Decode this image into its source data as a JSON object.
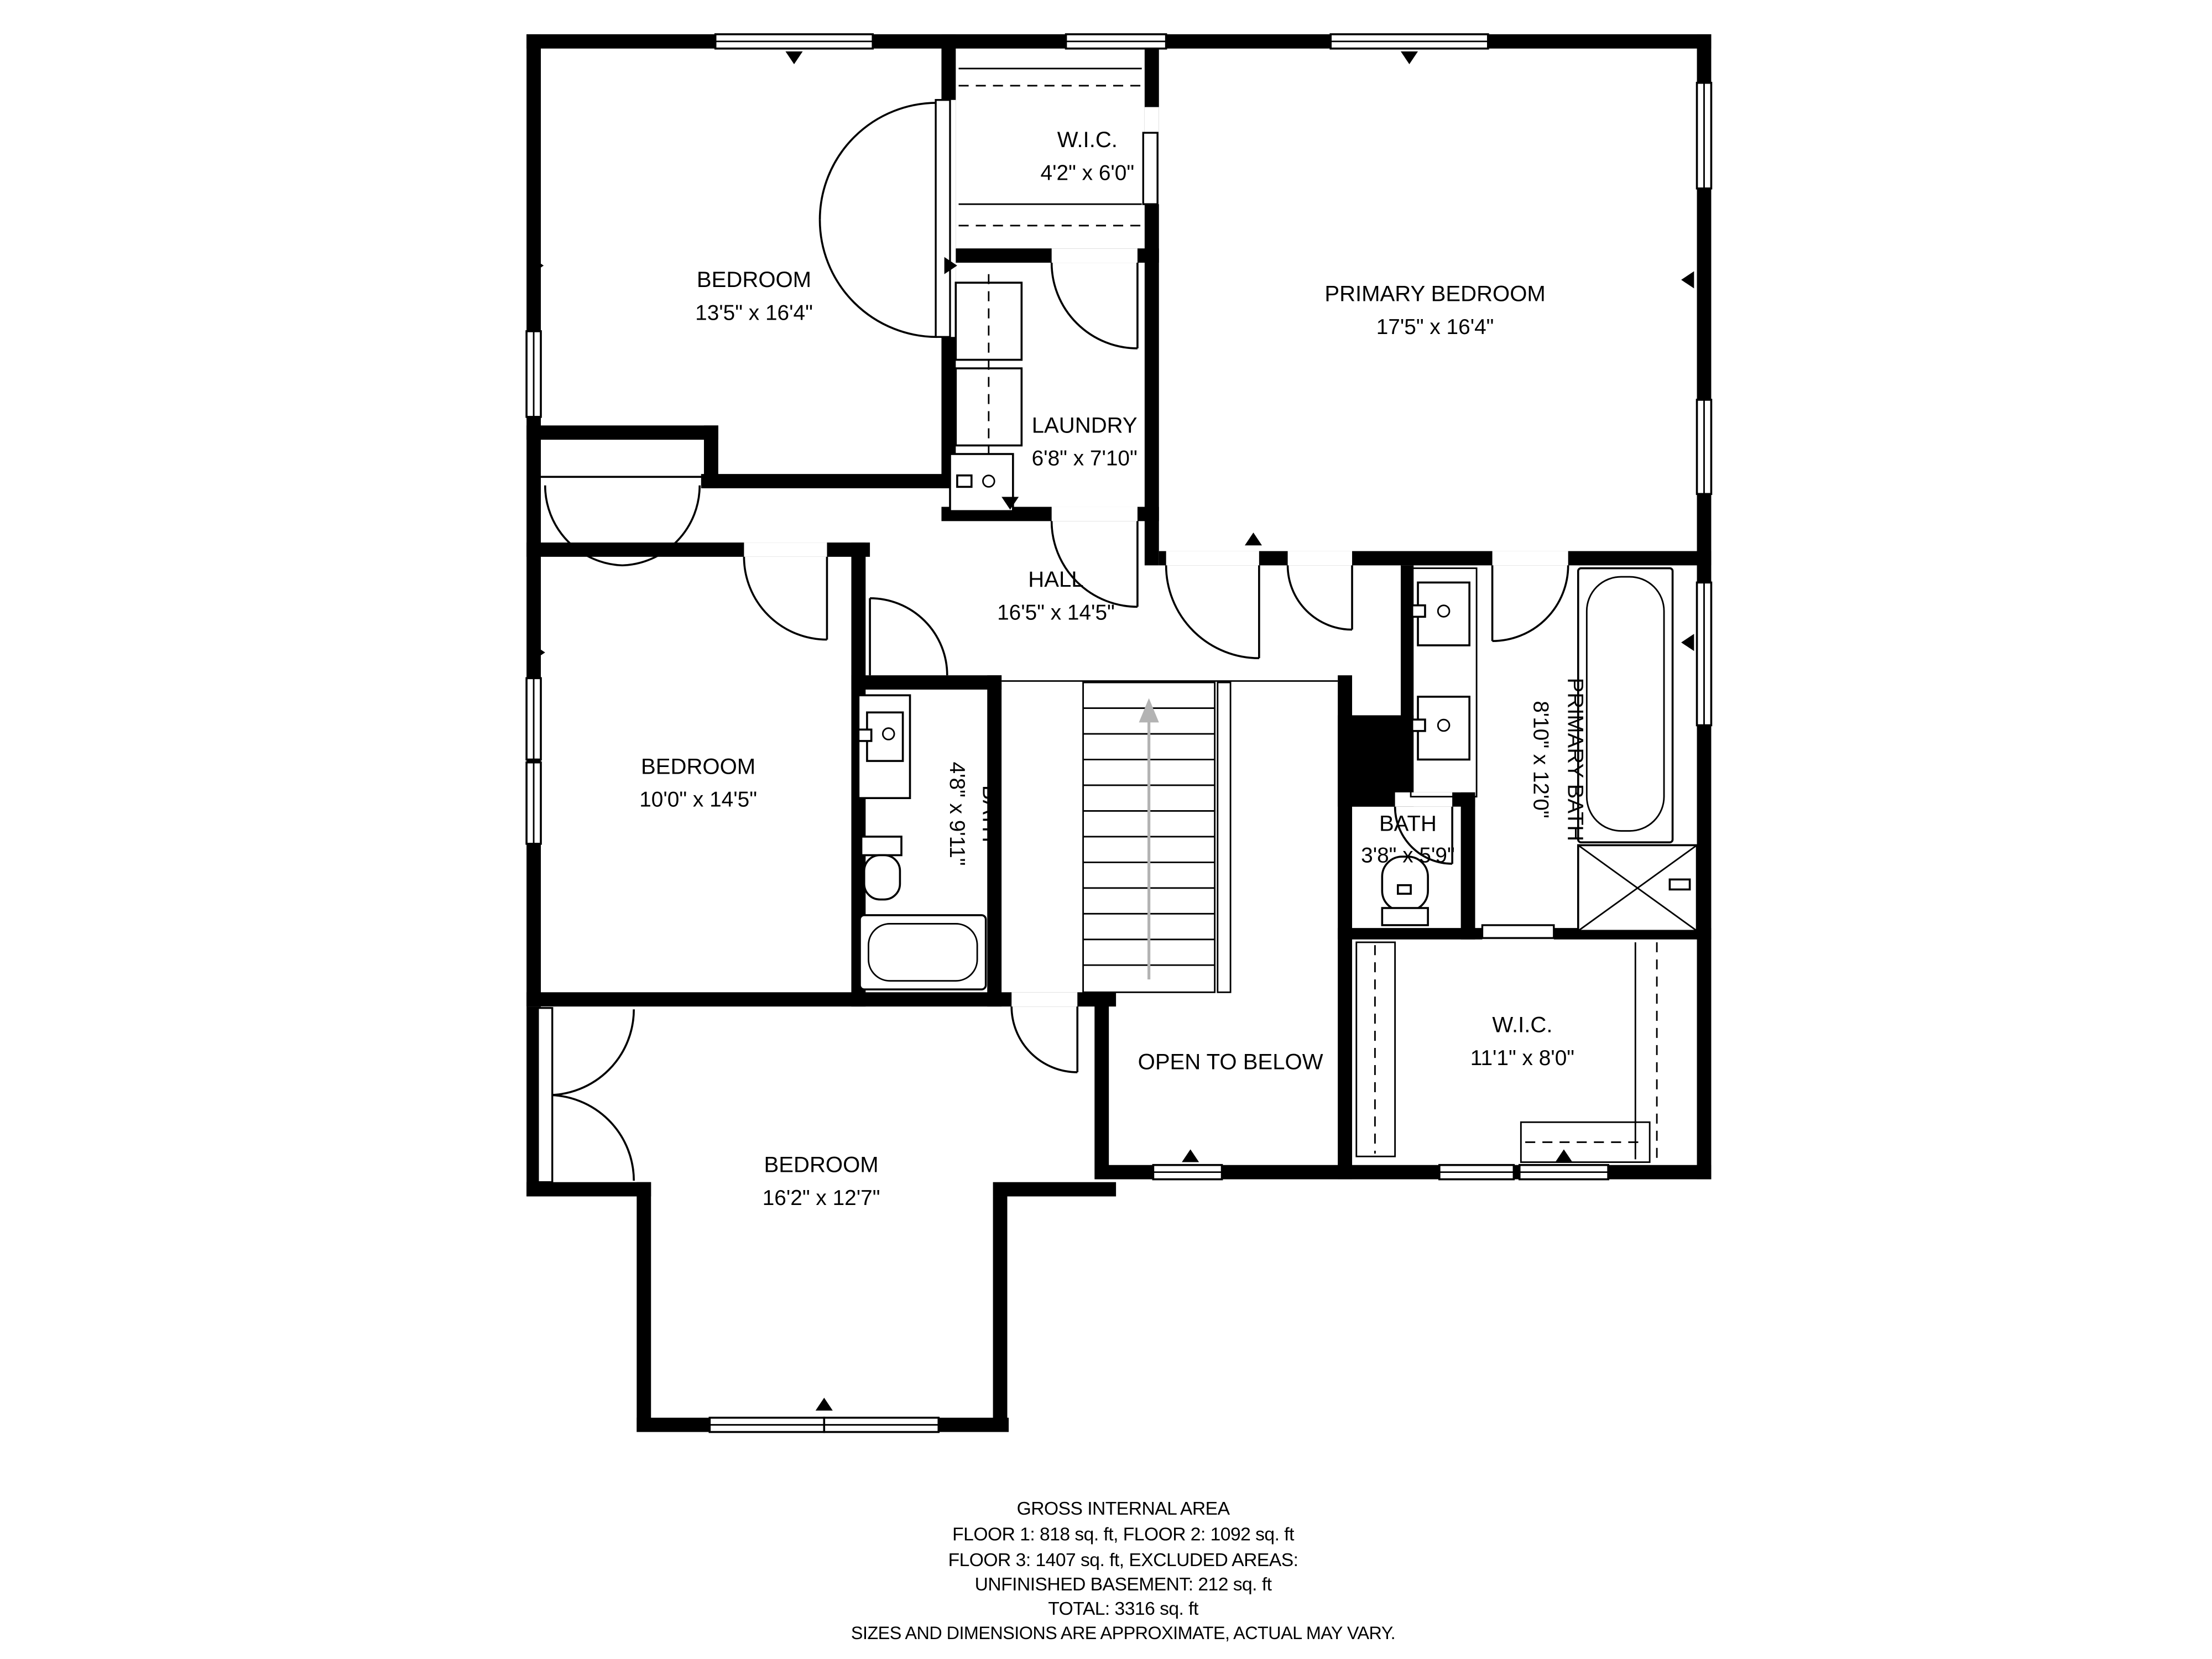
{
  "plan": {
    "title": "Floor plan - Floor 2",
    "rooms": [
      {
        "id": "bedroom-top-left",
        "name": "BEDROOM",
        "dims": "13'5\" x 16'4\""
      },
      {
        "id": "wic-top",
        "name": "W.I.C.",
        "dims": "4'2\" x 6'0\""
      },
      {
        "id": "primary-bedroom",
        "name": "PRIMARY BEDROOM",
        "dims": "17'5\" x 16'4\""
      },
      {
        "id": "laundry",
        "name": "LAUNDRY",
        "dims": "6'8\" x 7'10\""
      },
      {
        "id": "hall",
        "name": "HALL",
        "dims": "16'5\" x 14'5\""
      },
      {
        "id": "bedroom-left",
        "name": "BEDROOM",
        "dims": "10'0\" x 14'5\""
      },
      {
        "id": "bath-left",
        "name": "BATH",
        "dims": "4'8\" x 9'11\""
      },
      {
        "id": "bath-small",
        "name": "BATH",
        "dims": "3'8\" x 5'9\""
      },
      {
        "id": "primary-bath",
        "name": "PRIMARY BATH",
        "dims": "8'10\" x 12'0\""
      },
      {
        "id": "open-to-below",
        "name": "OPEN TO BELOW",
        "dims": ""
      },
      {
        "id": "wic-bottom",
        "name": "W.I.C.",
        "dims": "11'1\" x 8'0\""
      },
      {
        "id": "bedroom-bottom",
        "name": "BEDROOM",
        "dims": "16'2\" x 12'7\""
      }
    ],
    "footer": {
      "title": "GROSS INTERNAL AREA",
      "line1": "FLOOR 1: 818 sq. ft, FLOOR 2: 1092 sq. ft",
      "line2": "FLOOR 3: 1407 sq. ft, EXCLUDED AREAS:",
      "line3": "UNFINISHED BASEMENT: 212 sq. ft",
      "total": "TOTAL: 3316 sq. ft",
      "disclaimer": "SIZES AND DIMENSIONS ARE APPROXIMATE, ACTUAL MAY VARY."
    },
    "colors": {
      "wall": "#000000",
      "background": "#ffffff",
      "stair_arrow": "#b3b3b3"
    }
  }
}
